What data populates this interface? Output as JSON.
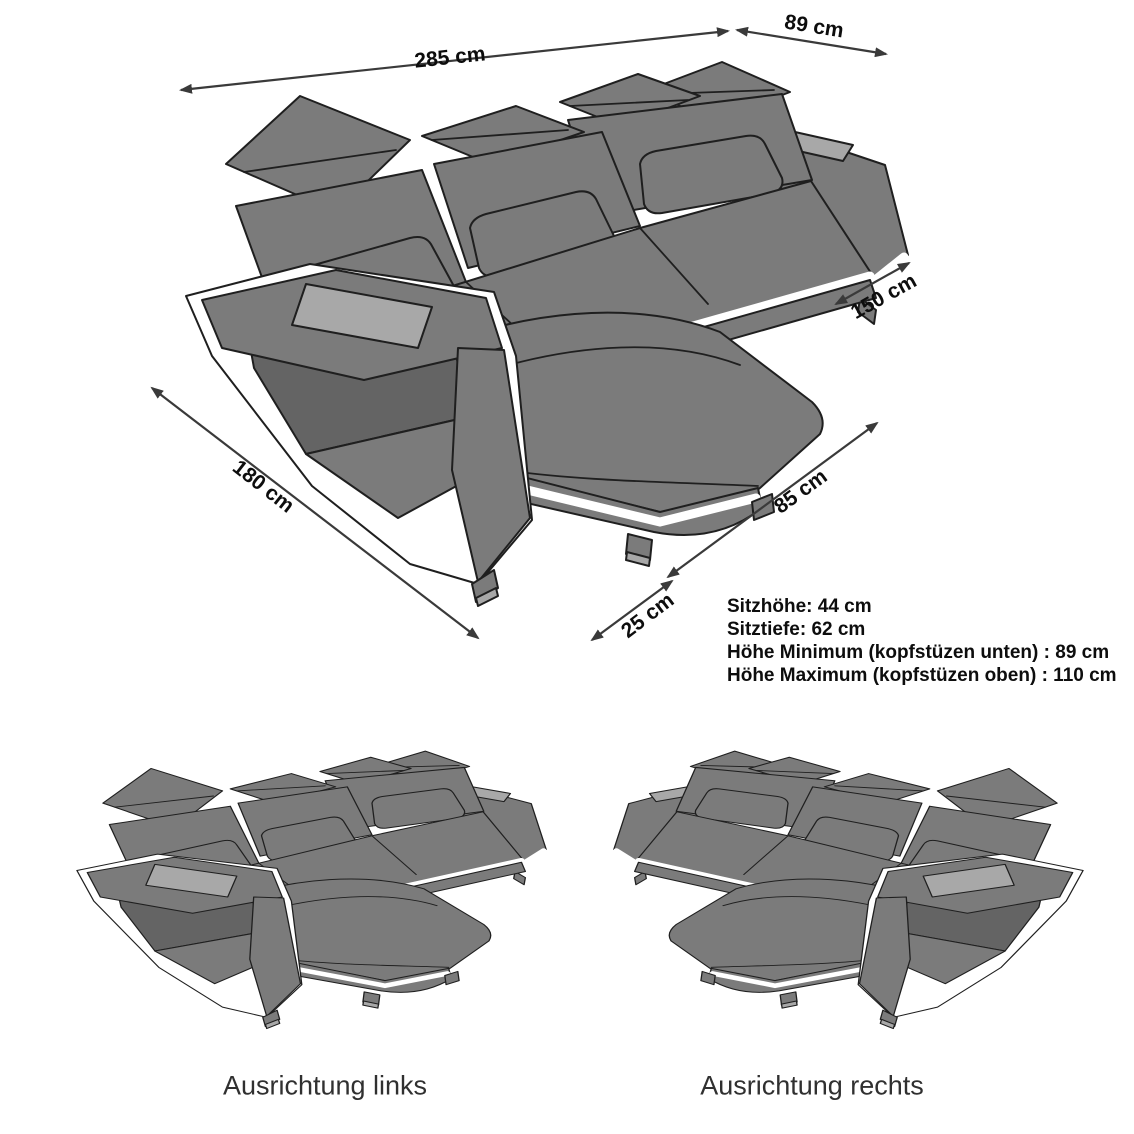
{
  "main_diagram": {
    "dimensions": [
      {
        "id": "width-total",
        "label": "285 cm"
      },
      {
        "id": "depth-end",
        "label": "89 cm"
      },
      {
        "id": "chaise-length",
        "label": "150 cm"
      },
      {
        "id": "side-total",
        "label": "180 cm"
      },
      {
        "id": "chaise-width",
        "label": "85 cm"
      },
      {
        "id": "arm-width",
        "label": "25 cm"
      }
    ],
    "specs": [
      "Sitzhöhe: 44 cm",
      "Sitztiefe: 62 cm",
      "Höhe Minimum (kopfstüzen unten) : 89 cm",
      "Höhe Maximum (kopfstüzen oben) : 110 cm"
    ]
  },
  "variants": [
    {
      "id": "links",
      "caption": "Ausrichtung links"
    },
    {
      "id": "rechts",
      "caption": "Ausrichtung rechts"
    }
  ],
  "colors": {
    "gray": "#7b7b7b",
    "dark": "#646464",
    "light": "#a8a8a8",
    "line": "#1f1f1f",
    "dim": "#3a3a3a",
    "text": "#0d0d0d",
    "caption": "#303030"
  }
}
